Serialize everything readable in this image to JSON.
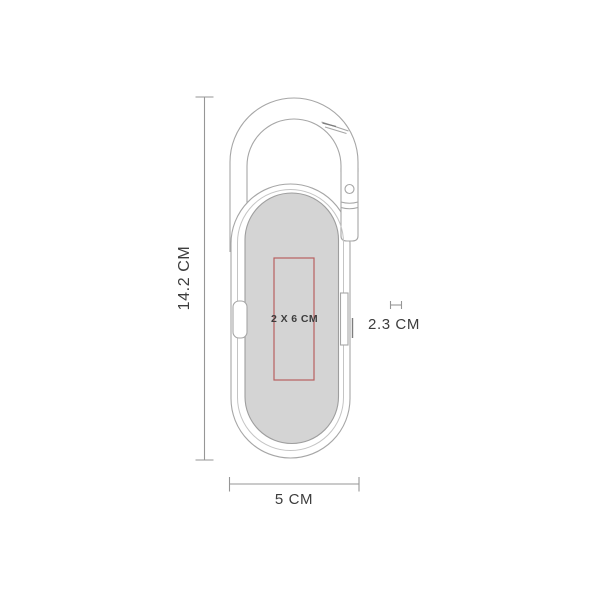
{
  "drawing": {
    "labels": {
      "height": "14.2 CM",
      "width": "5 CM",
      "depth": "2.3 CM",
      "imprint": "2 X 6 CM"
    },
    "colors": {
      "background": "#ffffff",
      "outline": "#a6a6a6",
      "inner_line": "#c4c4c4",
      "print_area_fill": "#d4d4d4",
      "print_area_stroke": "#9e9e9e",
      "imprint_outline": "#b86161",
      "dimension_line": "#969696",
      "detail_dark": "#7d7d7d",
      "text": "#3d3d3d"
    }
  }
}
